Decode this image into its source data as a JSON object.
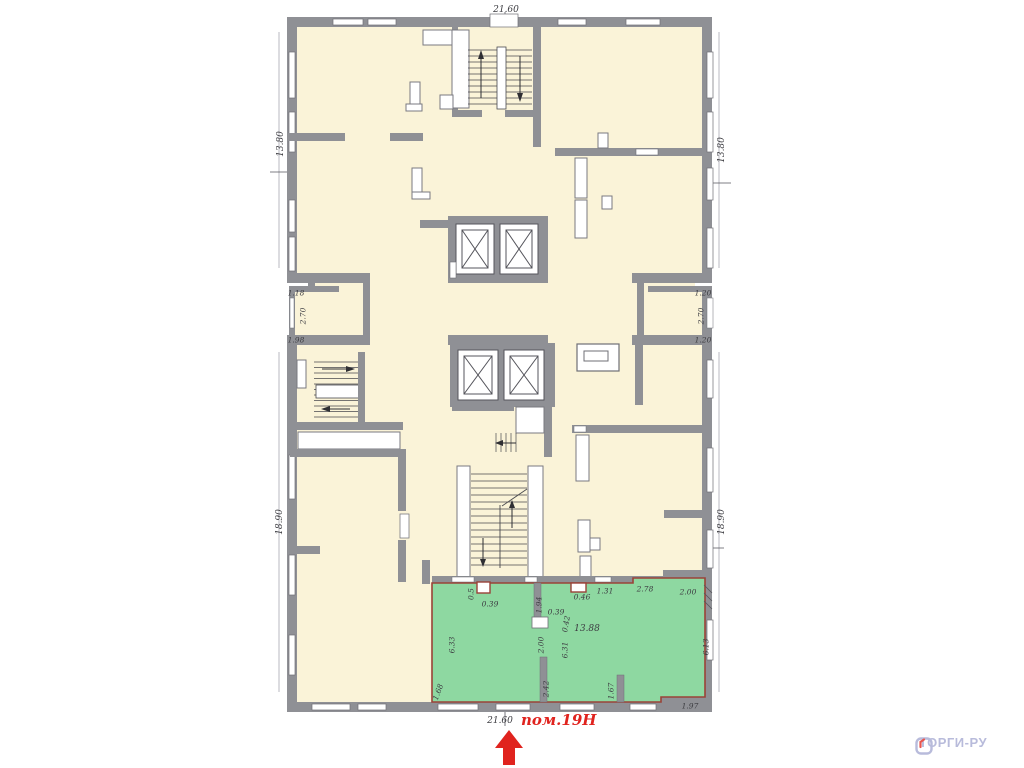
{
  "plan": {
    "room_label": "пом.19Н",
    "colors": {
      "floor": "#faf3d8",
      "wall": "#8f9095",
      "wall_edge": "#63636a",
      "window": "#ffffff",
      "highlight_room_fill": "#8ed8a1",
      "highlight_room_border": "#9a4238",
      "highlight_label": "#e0231e",
      "dimension_text": "#3c3c41"
    },
    "dimensions": [
      {
        "text": "21.60",
        "x": 506,
        "y": 10,
        "rot": 0,
        "big": true
      },
      {
        "text": "13.80",
        "x": 281,
        "y": 144,
        "rot": -90,
        "big": true
      },
      {
        "text": "13.80",
        "x": 722,
        "y": 150,
        "rot": -90,
        "big": true
      },
      {
        "text": "1.18",
        "x": 296,
        "y": 293,
        "rot": 0
      },
      {
        "text": "2.70",
        "x": 303,
        "y": 316,
        "rot": -90
      },
      {
        "text": "1.98",
        "x": 296,
        "y": 340,
        "rot": 0
      },
      {
        "text": "1.20",
        "x": 703,
        "y": 293,
        "rot": 0
      },
      {
        "text": "2.70",
        "x": 701,
        "y": 316,
        "rot": -90
      },
      {
        "text": "1.20",
        "x": 703,
        "y": 340,
        "rot": 0
      },
      {
        "text": "18.90",
        "x": 280,
        "y": 522,
        "rot": -90,
        "big": true
      },
      {
        "text": "18.90",
        "x": 722,
        "y": 522,
        "rot": -90,
        "big": true
      },
      {
        "text": "0.5",
        "x": 471,
        "y": 594,
        "rot": -90
      },
      {
        "text": "0.39",
        "x": 490,
        "y": 604,
        "rot": 0
      },
      {
        "text": "1.94",
        "x": 539,
        "y": 605,
        "rot": -90
      },
      {
        "text": "0.39",
        "x": 556,
        "y": 612,
        "rot": 0
      },
      {
        "text": "0.42",
        "x": 566,
        "y": 624,
        "rot": -80
      },
      {
        "text": "0.46",
        "x": 582,
        "y": 597,
        "rot": 0
      },
      {
        "text": "1.31",
        "x": 605,
        "y": 591,
        "rot": 0
      },
      {
        "text": "2.78",
        "x": 645,
        "y": 589,
        "rot": 0
      },
      {
        "text": "2.00",
        "x": 688,
        "y": 592,
        "rot": 0
      },
      {
        "text": "13.88",
        "x": 587,
        "y": 629,
        "rot": 0,
        "big": true
      },
      {
        "text": "6.33",
        "x": 452,
        "y": 645,
        "rot": -90
      },
      {
        "text": "2.00",
        "x": 541,
        "y": 645,
        "rot": -90
      },
      {
        "text": "6.31",
        "x": 565,
        "y": 650,
        "rot": -90
      },
      {
        "text": "6.13",
        "x": 706,
        "y": 647,
        "rot": -90
      },
      {
        "text": "1.68",
        "x": 438,
        "y": 692,
        "rot": -70
      },
      {
        "text": "2.42",
        "x": 546,
        "y": 689,
        "rot": -90
      },
      {
        "text": "1.67",
        "x": 611,
        "y": 691,
        "rot": -90
      },
      {
        "text": "1.97",
        "x": 690,
        "y": 706,
        "rot": 0
      },
      {
        "text": "21.60",
        "x": 500,
        "y": 721,
        "rot": 0,
        "big": true
      }
    ]
  },
  "watermark": {
    "text": "ТОРГИ-РУ",
    "color": "#b8bbdb",
    "accent": "#e8564f"
  }
}
